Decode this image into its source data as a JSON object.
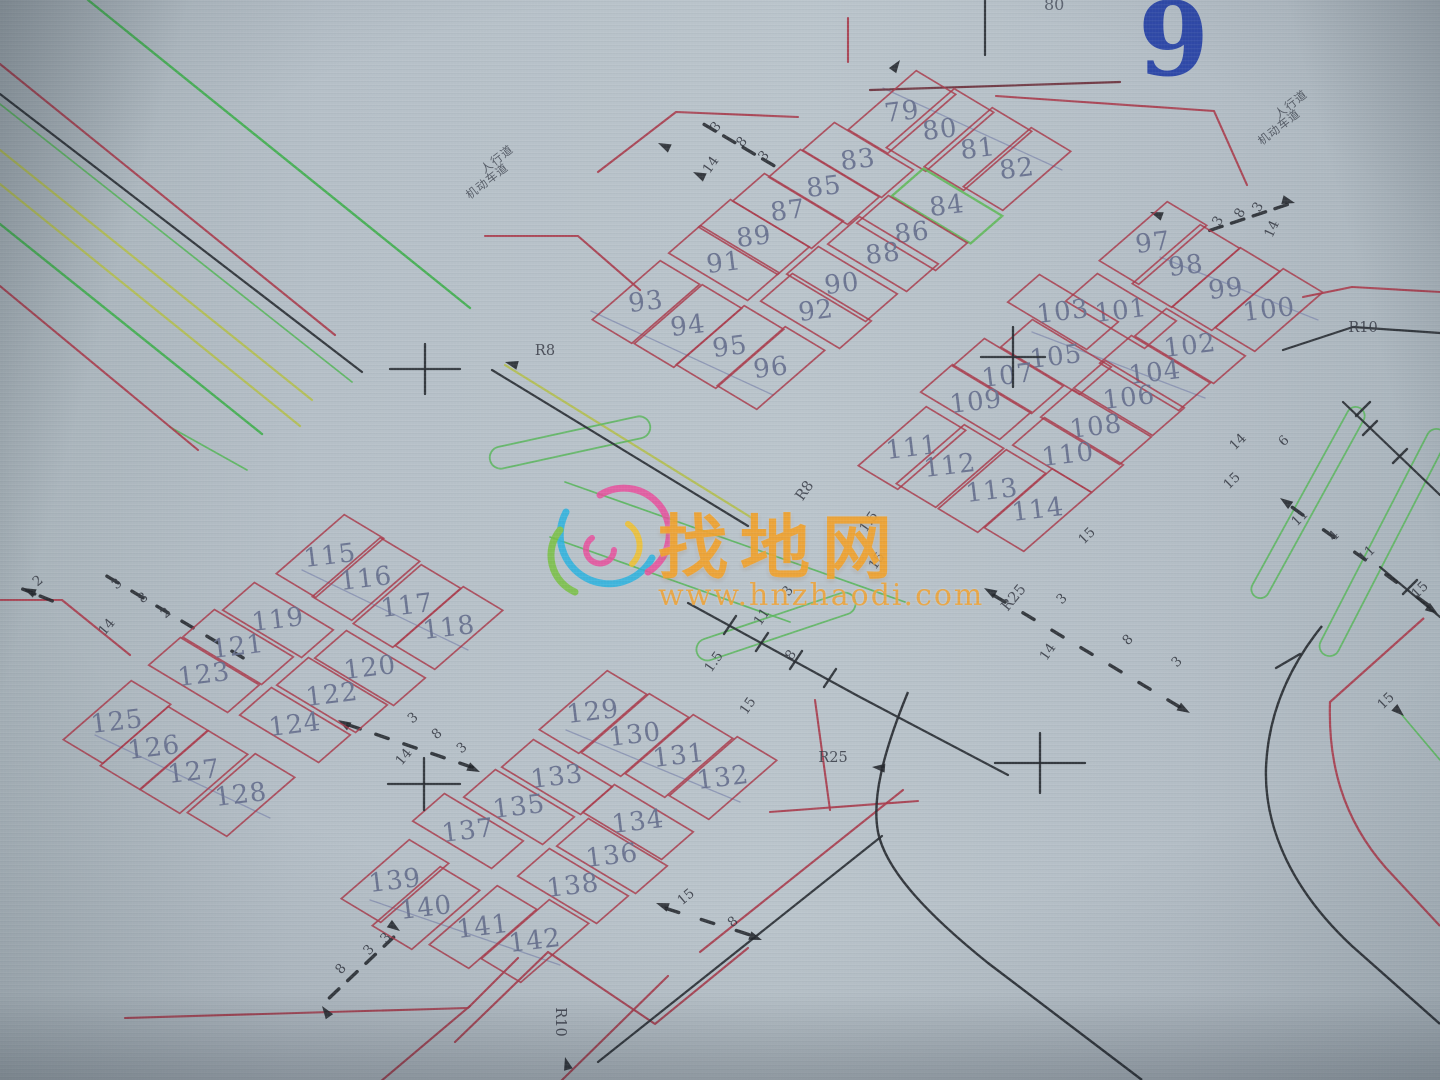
{
  "meta": {
    "sheet_number": "9",
    "top_number": "80"
  },
  "watermark": {
    "brand": "找地网",
    "url": "www.hnzhaodi.com",
    "brand_color": "#f0a22f"
  },
  "colors": {
    "parcel_red": "#a93b4b",
    "parcel_green": "#5cb854",
    "road_black": "#272b31",
    "road_dark_red": "#6b2f3a",
    "bright_green": "#3fae4d",
    "thin_green": "#59b65c",
    "yellow_green": "#b4bf4e",
    "slate": "#8089ad",
    "number_gray": "#68718f",
    "dim_text": "#343842",
    "sheet_blue": "#2440a6"
  },
  "plots": [
    {
      "n": "79",
      "x": 902,
      "y": 112,
      "o": 0
    },
    {
      "n": "80",
      "x": 940,
      "y": 130,
      "o": 0
    },
    {
      "n": "81",
      "x": 978,
      "y": 149,
      "o": 0
    },
    {
      "n": "82",
      "x": 1017,
      "y": 169,
      "o": 0
    },
    {
      "n": "83",
      "x": 858,
      "y": 160,
      "o": 1
    },
    {
      "n": "84",
      "x": 947,
      "y": 206,
      "o": 1,
      "green": true
    },
    {
      "n": "85",
      "x": 824,
      "y": 187,
      "o": 1
    },
    {
      "n": "86",
      "x": 912,
      "y": 233,
      "o": 1
    },
    {
      "n": "87",
      "x": 788,
      "y": 211,
      "o": 1
    },
    {
      "n": "88",
      "x": 883,
      "y": 254,
      "o": 1
    },
    {
      "n": "89",
      "x": 754,
      "y": 237,
      "o": 1
    },
    {
      "n": "90",
      "x": 842,
      "y": 284,
      "o": 1
    },
    {
      "n": "91",
      "x": 724,
      "y": 263,
      "o": 1
    },
    {
      "n": "92",
      "x": 816,
      "y": 311,
      "o": 1
    },
    {
      "n": "93",
      "x": 646,
      "y": 302,
      "o": 0
    },
    {
      "n": "94",
      "x": 688,
      "y": 326,
      "o": 0
    },
    {
      "n": "95",
      "x": 730,
      "y": 347,
      "o": 0
    },
    {
      "n": "96",
      "x": 771,
      "y": 368,
      "o": 0
    },
    {
      "n": "97",
      "x": 1153,
      "y": 243,
      "o": 0
    },
    {
      "n": "98",
      "x": 1186,
      "y": 266,
      "o": 0
    },
    {
      "n": "99",
      "x": 1226,
      "y": 289,
      "o": 0
    },
    {
      "n": "100",
      "x": 1269,
      "y": 310,
      "o": 0
    },
    {
      "n": "101",
      "x": 1121,
      "y": 311,
      "o": 1
    },
    {
      "n": "102",
      "x": 1190,
      "y": 346,
      "o": 1
    },
    {
      "n": "103",
      "x": 1063,
      "y": 312,
      "o": 1
    },
    {
      "n": "104",
      "x": 1155,
      "y": 373,
      "o": 1
    },
    {
      "n": "105",
      "x": 1056,
      "y": 357,
      "o": 1
    },
    {
      "n": "106",
      "x": 1129,
      "y": 398,
      "o": 1
    },
    {
      "n": "107",
      "x": 1008,
      "y": 376,
      "o": 1
    },
    {
      "n": "108",
      "x": 1096,
      "y": 427,
      "o": 1
    },
    {
      "n": "109",
      "x": 976,
      "y": 402,
      "o": 1
    },
    {
      "n": "110",
      "x": 1068,
      "y": 455,
      "o": 1
    },
    {
      "n": "111",
      "x": 912,
      "y": 448,
      "o": 0
    },
    {
      "n": "112",
      "x": 950,
      "y": 466,
      "o": 0
    },
    {
      "n": "113",
      "x": 992,
      "y": 491,
      "o": 0
    },
    {
      "n": "114",
      "x": 1038,
      "y": 510,
      "o": 0
    },
    {
      "n": "115",
      "x": 330,
      "y": 556,
      "o": 0
    },
    {
      "n": "116",
      "x": 366,
      "y": 579,
      "o": 0
    },
    {
      "n": "117",
      "x": 407,
      "y": 606,
      "o": 0
    },
    {
      "n": "118",
      "x": 449,
      "y": 628,
      "o": 0
    },
    {
      "n": "119",
      "x": 278,
      "y": 620,
      "o": 1
    },
    {
      "n": "120",
      "x": 370,
      "y": 668,
      "o": 1
    },
    {
      "n": "121",
      "x": 238,
      "y": 647,
      "o": 1
    },
    {
      "n": "122",
      "x": 332,
      "y": 695,
      "o": 1
    },
    {
      "n": "123",
      "x": 204,
      "y": 675,
      "o": 1
    },
    {
      "n": "124",
      "x": 295,
      "y": 725,
      "o": 1
    },
    {
      "n": "125",
      "x": 117,
      "y": 722,
      "o": 0
    },
    {
      "n": "126",
      "x": 154,
      "y": 748,
      "o": 0
    },
    {
      "n": "127",
      "x": 194,
      "y": 772,
      "o": 0
    },
    {
      "n": "128",
      "x": 241,
      "y": 795,
      "o": 0
    },
    {
      "n": "129",
      "x": 593,
      "y": 712,
      "o": 0
    },
    {
      "n": "130",
      "x": 635,
      "y": 735,
      "o": 0
    },
    {
      "n": "131",
      "x": 679,
      "y": 756,
      "o": 0
    },
    {
      "n": "132",
      "x": 723,
      "y": 778,
      "o": 0
    },
    {
      "n": "133",
      "x": 557,
      "y": 777,
      "o": 1
    },
    {
      "n": "134",
      "x": 638,
      "y": 822,
      "o": 1
    },
    {
      "n": "135",
      "x": 519,
      "y": 807,
      "o": 1
    },
    {
      "n": "136",
      "x": 612,
      "y": 856,
      "o": 1
    },
    {
      "n": "137",
      "x": 468,
      "y": 831,
      "o": 1
    },
    {
      "n": "138",
      "x": 573,
      "y": 886,
      "o": 1
    },
    {
      "n": "139",
      "x": 395,
      "y": 881,
      "o": 0
    },
    {
      "n": "140",
      "x": 426,
      "y": 908,
      "o": 0
    },
    {
      "n": "141",
      "x": 483,
      "y": 927,
      "o": 0
    },
    {
      "n": "142",
      "x": 535,
      "y": 941,
      "o": 0
    }
  ],
  "ref_labels": [
    {
      "t": "R8",
      "x": 545,
      "y": 351,
      "r": 0
    },
    {
      "t": "R8",
      "x": 805,
      "y": 491,
      "r": -55
    },
    {
      "t": "R25",
      "x": 833,
      "y": 758,
      "r": 0
    },
    {
      "t": "R25",
      "x": 1014,
      "y": 598,
      "r": -50
    },
    {
      "t": "R10",
      "x": 1363,
      "y": 328,
      "r": 0
    },
    {
      "t": "R10",
      "x": 560,
      "y": 1022,
      "r": 90
    }
  ],
  "road_names": [
    {
      "t": "人行道",
      "x": 497,
      "y": 159,
      "r": -38
    },
    {
      "t": "机动车道",
      "x": 487,
      "y": 181,
      "r": -38
    },
    {
      "t": "人行道",
      "x": 1291,
      "y": 104,
      "r": -38
    },
    {
      "t": "机动车道",
      "x": 1279,
      "y": 127,
      "r": -38
    }
  ],
  "dim_labels": [
    {
      "t": "3",
      "x": 716,
      "y": 127,
      "r": -50
    },
    {
      "t": "8",
      "x": 742,
      "y": 142,
      "r": -50
    },
    {
      "t": "3",
      "x": 764,
      "y": 156,
      "r": -50
    },
    {
      "t": "14",
      "x": 711,
      "y": 165,
      "r": -55
    },
    {
      "t": "2",
      "x": 38,
      "y": 581,
      "r": -40
    },
    {
      "t": "3",
      "x": 117,
      "y": 584,
      "r": -40
    },
    {
      "t": "8",
      "x": 143,
      "y": 598,
      "r": -40
    },
    {
      "t": "2",
      "x": 166,
      "y": 613,
      "r": -40
    },
    {
      "t": "14",
      "x": 107,
      "y": 627,
      "r": -50
    },
    {
      "t": "3",
      "x": 413,
      "y": 718,
      "r": -40
    },
    {
      "t": "8",
      "x": 437,
      "y": 734,
      "r": -40
    },
    {
      "t": "3",
      "x": 462,
      "y": 748,
      "r": -40
    },
    {
      "t": "14",
      "x": 404,
      "y": 757,
      "r": -50
    },
    {
      "t": "3",
      "x": 1062,
      "y": 599,
      "r": -45
    },
    {
      "t": "8",
      "x": 1128,
      "y": 640,
      "r": -45
    },
    {
      "t": "3",
      "x": 1177,
      "y": 662,
      "r": -45
    },
    {
      "t": "14",
      "x": 1048,
      "y": 652,
      "r": -55
    },
    {
      "t": "3",
      "x": 1218,
      "y": 221,
      "r": -60
    },
    {
      "t": "8",
      "x": 1240,
      "y": 213,
      "r": -60
    },
    {
      "t": "3",
      "x": 1258,
      "y": 207,
      "r": -60
    },
    {
      "t": "14",
      "x": 1272,
      "y": 229,
      "r": -65
    },
    {
      "t": "8",
      "x": 341,
      "y": 969,
      "r": -50
    },
    {
      "t": "3",
      "x": 369,
      "y": 950,
      "r": -50
    },
    {
      "t": "3",
      "x": 386,
      "y": 938,
      "r": -50
    },
    {
      "t": "14",
      "x": 1238,
      "y": 442,
      "r": -45
    },
    {
      "t": "6",
      "x": 1284,
      "y": 441,
      "r": -45
    },
    {
      "t": "15",
      "x": 1232,
      "y": 481,
      "r": -45
    },
    {
      "t": "11",
      "x": 1300,
      "y": 518,
      "r": -45
    },
    {
      "t": "4",
      "x": 1334,
      "y": 536,
      "r": -45
    },
    {
      "t": "11",
      "x": 1367,
      "y": 554,
      "r": -45
    },
    {
      "t": "15",
      "x": 1420,
      "y": 590,
      "r": -45
    },
    {
      "t": "3",
      "x": 788,
      "y": 591,
      "r": -55
    },
    {
      "t": "11",
      "x": 762,
      "y": 617,
      "r": -55
    },
    {
      "t": "8",
      "x": 791,
      "y": 655,
      "r": -55
    },
    {
      "t": "1.5",
      "x": 714,
      "y": 662,
      "r": -55
    },
    {
      "t": "15",
      "x": 748,
      "y": 706,
      "r": -55
    },
    {
      "t": "1.5",
      "x": 869,
      "y": 522,
      "r": -55
    },
    {
      "t": "15",
      "x": 877,
      "y": 561,
      "r": -55
    },
    {
      "t": "15",
      "x": 1087,
      "y": 536,
      "r": -45
    },
    {
      "t": "15",
      "x": 686,
      "y": 897,
      "r": -40
    },
    {
      "t": "8",
      "x": 733,
      "y": 922,
      "r": -40
    },
    {
      "t": "15",
      "x": 1386,
      "y": 701,
      "r": -45
    }
  ],
  "crosses": [
    {
      "x": 425,
      "y": 369,
      "w": 70,
      "h": 50
    },
    {
      "x": 1013,
      "y": 357,
      "w": 64,
      "h": 60
    },
    {
      "x": 424,
      "y": 784,
      "w": 72,
      "h": 52
    },
    {
      "x": 1040,
      "y": 763,
      "w": 90,
      "h": 60
    }
  ],
  "roads": {
    "red_polylines": [
      [
        0,
        64,
        335,
        335
      ],
      [
        0,
        286,
        198,
        450
      ],
      [
        598,
        172,
        676,
        112,
        798,
        117
      ],
      [
        485,
        236,
        578,
        236,
        640,
        290
      ],
      [
        0,
        600,
        62,
        600,
        130,
        655
      ],
      [
        125,
        1018,
        468,
        1008,
        518,
        958
      ],
      [
        455,
        1042,
        548,
        952,
        655,
        1024,
        748,
        948
      ],
      [
        380,
        1082,
        470,
        1006
      ],
      [
        560,
        1082,
        668,
        976
      ],
      [
        815,
        700,
        830,
        810
      ],
      [
        770,
        812,
        918,
        801
      ],
      [
        700,
        952,
        903,
        790
      ],
      [
        996,
        96,
        1214,
        111,
        1247,
        185
      ],
      [
        848,
        18,
        848,
        62
      ],
      [
        1303,
        297,
        1352,
        287,
        1440,
        292
      ]
    ],
    "red_paths": [
      "M 1424,618 L 1330,702 C 1328,762 1342,818 1386,868 L 1440,926"
    ],
    "dark_polylines": [
      [
        870,
        90,
        1120,
        82
      ]
    ],
    "black_polylines": [
      [
        0,
        94,
        362,
        372
      ],
      [
        492,
        370,
        748,
        526
      ],
      [
        985,
        0,
        985,
        55
      ],
      [
        688,
        603,
        858,
        696,
        1008,
        775
      ],
      [
        598,
        1062,
        882,
        836
      ],
      [
        1283,
        350,
        1353,
        327,
        1440,
        333
      ],
      [
        1343,
        402,
        1440,
        495
      ],
      [
        1380,
        567,
        1440,
        617
      ]
    ],
    "black_paths": [
      "M 908,692 C 882,755 872,800 878,832 C 886,872 932,918 988,963 L 1142,1080",
      "M 1322,626 C 1288,668 1268,716 1266,768 C 1264,830 1294,892 1352,946 L 1440,1024"
    ],
    "green_lines": [
      [
        88,
        0,
        470,
        308
      ],
      [
        0,
        224,
        262,
        434
      ]
    ],
    "green_thin": [
      [
        0,
        104,
        352,
        382
      ],
      [
        565,
        482,
        905,
        602
      ],
      [
        550,
        537,
        790,
        622
      ],
      [
        170,
        427,
        247,
        470
      ],
      [
        1402,
        715,
        1440,
        760
      ]
    ],
    "yellowgreen_lines": [
      [
        0,
        150,
        312,
        400
      ],
      [
        0,
        184,
        300,
        426
      ],
      [
        505,
        365,
        752,
        518
      ]
    ],
    "slate_lines": [
      [
        883,
        88,
        1062,
        170
      ],
      [
        591,
        311,
        773,
        395
      ],
      [
        1160,
        257,
        1318,
        320
      ],
      [
        1032,
        332,
        1205,
        398
      ],
      [
        302,
        570,
        468,
        650
      ],
      [
        95,
        735,
        270,
        818
      ],
      [
        566,
        730,
        740,
        802
      ],
      [
        370,
        900,
        560,
        965
      ]
    ],
    "stadiums": [
      {
        "x1": 490,
        "y1": 460,
        "x2": 650,
        "y2": 425,
        "r": 11
      },
      {
        "x1": 697,
        "y1": 653,
        "x2": 855,
        "y2": 600,
        "r": 11
      },
      {
        "x1": 1360,
        "y1": 408,
        "x2": 1256,
        "y2": 597,
        "r": 9
      },
      {
        "x1": 1441,
        "y1": 430,
        "x2": 1325,
        "y2": 655,
        "r": 10
      }
    ],
    "ticks": [
      [
        724,
        634,
        736,
        616
      ],
      [
        756,
        651,
        768,
        633
      ],
      [
        790,
        669,
        802,
        651
      ],
      [
        824,
        687,
        836,
        669
      ],
      [
        1356,
        416,
        1370,
        402
      ],
      [
        1363,
        435,
        1377,
        421
      ],
      [
        1393,
        463,
        1407,
        449
      ],
      [
        1403,
        594,
        1417,
        580
      ],
      [
        1276,
        668,
        1300,
        654
      ]
    ],
    "dash_chains": [
      {
        "x1": 700,
        "y1": 122,
        "x2": 778,
        "y2": 168,
        "n": 4
      },
      {
        "x1": 100,
        "y1": 572,
        "x2": 250,
        "y2": 662,
        "n": 6
      },
      {
        "x1": 20,
        "y1": 588,
        "x2": 55,
        "y2": 602,
        "n": 2
      },
      {
        "x1": 340,
        "y1": 722,
        "x2": 480,
        "y2": 770,
        "n": 5
      },
      {
        "x1": 985,
        "y1": 590,
        "x2": 1188,
        "y2": 712,
        "n": 7
      },
      {
        "x1": 1205,
        "y1": 232,
        "x2": 1292,
        "y2": 203,
        "n": 4
      },
      {
        "x1": 325,
        "y1": 1002,
        "x2": 398,
        "y2": 933,
        "n": 4
      },
      {
        "x1": 1282,
        "y1": 500,
        "x2": 1438,
        "y2": 612,
        "n": 5
      },
      {
        "x1": 655,
        "y1": 905,
        "x2": 760,
        "y2": 938,
        "n": 3
      }
    ],
    "arrowheads": [
      {
        "x": 505,
        "y": 362,
        "rot": 195
      },
      {
        "x": 565,
        "y": 1057,
        "rot": 255
      },
      {
        "x": 872,
        "y": 767,
        "rot": 185
      },
      {
        "x": 1404,
        "y": 716,
        "rot": 42
      },
      {
        "x": 900,
        "y": 60,
        "rot": -55
      },
      {
        "x": 1150,
        "y": 212,
        "rot": 200
      },
      {
        "x": 693,
        "y": 172,
        "rot": 205
      },
      {
        "x": 658,
        "y": 143,
        "rot": 205
      },
      {
        "x": 23,
        "y": 588,
        "rot": 205
      },
      {
        "x": 338,
        "y": 720,
        "rot": 210
      },
      {
        "x": 480,
        "y": 772,
        "rot": 25
      },
      {
        "x": 984,
        "y": 588,
        "rot": 210
      },
      {
        "x": 1190,
        "y": 713,
        "rot": 30
      },
      {
        "x": 1295,
        "y": 203,
        "rot": 15
      },
      {
        "x": 322,
        "y": 1006,
        "rot": 235
      },
      {
        "x": 400,
        "y": 931,
        "rot": 35
      },
      {
        "x": 1280,
        "y": 498,
        "rot": 215
      },
      {
        "x": 1438,
        "y": 614,
        "rot": 35
      },
      {
        "x": 656,
        "y": 903,
        "rot": 200
      },
      {
        "x": 762,
        "y": 940,
        "rot": 20
      }
    ]
  }
}
